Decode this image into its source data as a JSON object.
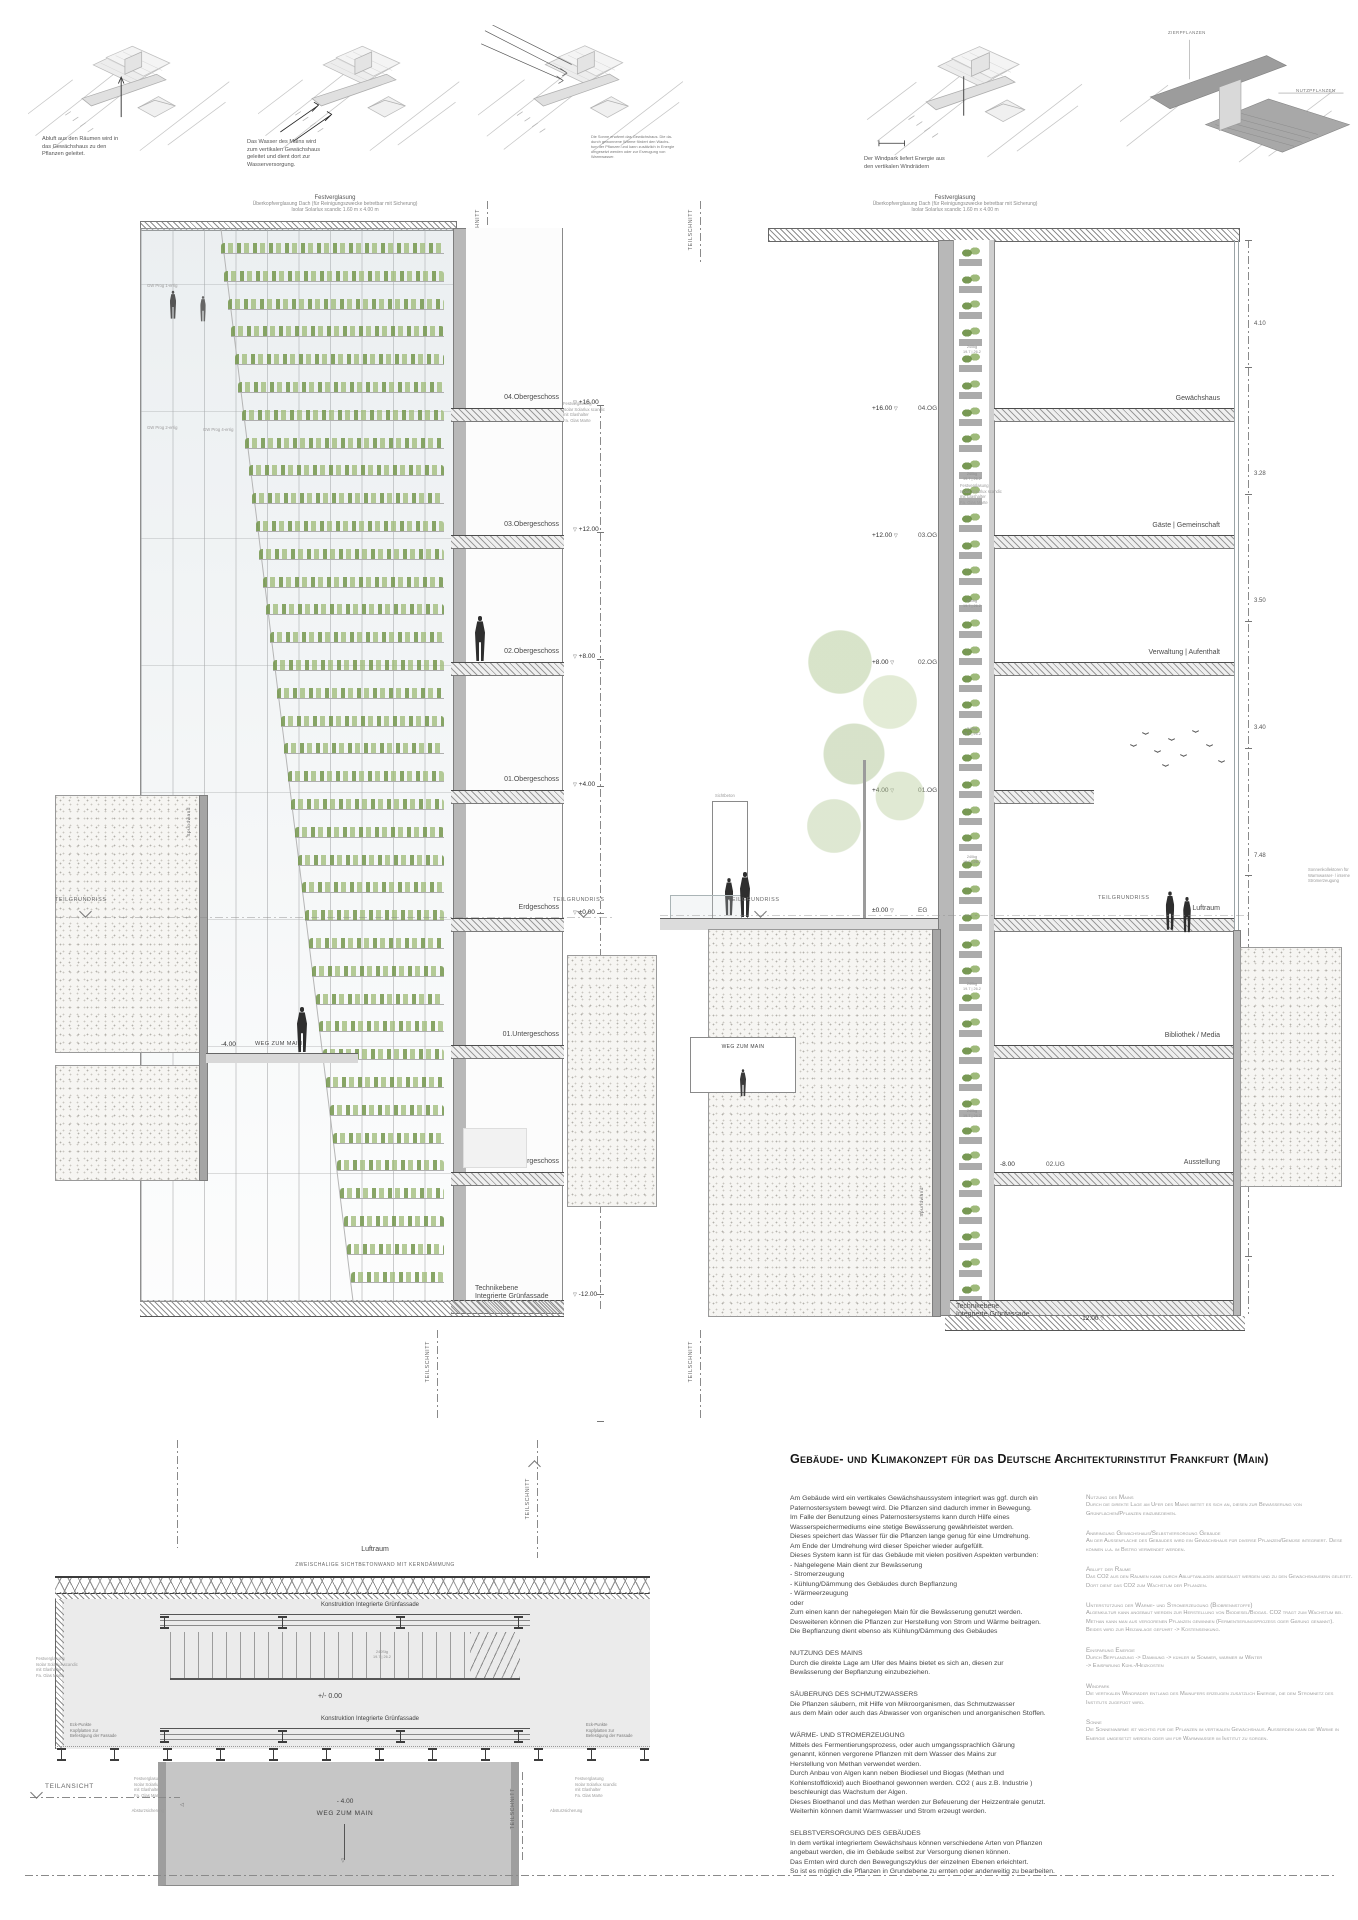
{
  "top_row": {
    "captions": [
      "Abluft aus den Räumen wird in\ndas Gewächshaus zu den\nPflanzen geleitet.",
      "Das Wasser des Mains wird\nzum vertikalen Gewächshaus\ngeleitet und dient dort zur\nWasserversorgung.",
      "Die Sonne erwärmt das Gewächshaus. Die da-\ndurch gewonnene Wärme fördert den Wachs-\ntum der Pflanzen und kann zusätzlich in Energie\numgesetzt werden oder zur Erzeugung von\nWarmwasser.",
      "Der Windpark liefert Energie aus\nden vertikalen Windrädern"
    ],
    "d5_labels": {
      "top": "ZIERPFLANZEN",
      "right": "NUTZPFLANZEN"
    }
  },
  "sections_common": {
    "roof_note_line1": "Festverglasung",
    "roof_note_line2": "Überkopfverglasung Dach (für Reinigungszwecke betretbar mit Sicherung)",
    "roof_note_line3": "Isolar Solarlux scandic 1.60 m x 4.00 m",
    "glazing_note": "Festverglasung\nIsolar Solarlux scandic\nmit Glashalter\nFa. Glas Marte",
    "teilschnitt": "TEILSCHNITT",
    "teilansicht": "TEILANSICHT",
    "teilgrundriss": "TEILGRUNDRISS",
    "spundwand": "Spundwand"
  },
  "left_section": {
    "floors": [
      {
        "elev": "+16.00",
        "label": "04.Obergeschoss"
      },
      {
        "elev": "+12.00",
        "label": "03.Obergeschoss"
      },
      {
        "elev": "+8.00",
        "label": "02.Obergeschoss"
      },
      {
        "elev": "+4.00",
        "label": "01.Obergeschoss"
      },
      {
        "elev": "±0.00",
        "label": "Erdgeschoss"
      },
      {
        "elev": "-4.00",
        "label": "01.Untergeschoss"
      },
      {
        "elev": "-8.00",
        "label": "02.Untergeschoss"
      },
      {
        "elev": "-12.00",
        "label": "Technikebene\nIntegrierte Grünfassade"
      }
    ],
    "walkway_elev": "-4.00",
    "walkway_label": "WEG ZUM MAIN",
    "fig_notes": [
      "GW Prog 1-errig",
      "GW Prog 2-errig",
      "GW Prog 4-errig"
    ]
  },
  "right_section": {
    "levels": [
      {
        "elev": "+16.00",
        "tag": "04.OG",
        "room": "Gewächshaus"
      },
      {
        "elev": "+12.00",
        "tag": "03.OG",
        "room": "Gäste | Gemeinschaft"
      },
      {
        "elev": "+8.00",
        "tag": "02.OG",
        "room": "Verwaltung | Aufenthalt"
      },
      {
        "elev": "+4.00",
        "tag": "01.OG",
        "room": ""
      },
      {
        "elev": "±0.00",
        "tag": "EG",
        "room": "Luftraum"
      },
      {
        "elev": "-4.00",
        "tag": "01.UG",
        "room": "Bibliothek / Media"
      },
      {
        "elev": "-8.00",
        "tag": "02.UG",
        "room": "Ausstellung"
      },
      {
        "elev": "-12.00",
        "tag": "",
        "room": "Technikebene\nIntegrierte Grünfassade"
      }
    ],
    "dims": [
      "4.10",
      "3.28",
      "3.50",
      "3.40",
      "7.48",
      "3.50",
      "3.50"
    ],
    "box_label": "240kg\n19.7 | 26.2",
    "sichtbeton": "Sichtbeton",
    "weg_label": "WEG ZUM MAIN",
    "sonnenkollektor_note": "Sonnenkollektoren für Warmwasser- / interne Stromerzeugung"
  },
  "detail": {
    "luftraum": "Luftraum",
    "wand_note": "ZWEISCHALIGE SICHTBETONWAND MIT KERNDÄMMUNG",
    "konstruktion": "Konstruktion Integrierte Grünfassade",
    "level": "+/- 0.00",
    "eckpunkte": "Eck-Punkte\nKopfplatten zur\nBefestigung der Fassade",
    "stair_dim": "240Stg\n19.7 | 26.2",
    "absturz": "Absturzsicherung",
    "minus4": "- 4.00",
    "weg": "WEG ZUM MAIN"
  },
  "text_block": {
    "title": "Gebäude- und Klimakonzept für das Deutsche Architekturinstitut Frankfurt (Main)",
    "left_col": [
      {
        "heading": "",
        "body": "Am Gebäude wird ein vertikales Gewächshaussystem integriert was ggf. durch ein Paternostersystem bewegt wird. Die Pflanzen sind dadurch immer in Bewegung.\nIm Falle der Benutzung eines Paternostersystems kann durch Hilfe eines Wasserspeichermediums eine stetige Bewässerung gewährleistet werden.\nDieses speichert das Wasser für die Pflanzen lange genug für eine Umdrehung.\nAm Ende der Umdrehung wird dieser Speicher wieder aufgefüllt.\nDieses System kann ist für das Gebäude mit vielen positiven Aspekten verbunden:\n- Nahgelegene Main dient zur Bewässerung\n- Stromerzeugung\n- Kühlung/Dämmung des Gebäudes durch Bepflanzung\n- Wärmeerzeugung\noder\nZum einen kann der nahegelegen Main für die Bewässerung genutzt werden.\nDesweiteren können die Pflanzen zur Herstellung von Strom und Wärme beitragen.\nDie Bepflanzung dient ebenso als Kühlung/Dämmung des Gebäudes"
      },
      {
        "heading": "NUTZUNG DES MAINS",
        "body": "Durch die direkte Lage am Ufer des Mains bietet es sich an, diesen zur\nBewässerung der Bepflanzung einzubeziehen."
      },
      {
        "heading": "SÄUBERUNG DES SCHMUTZWASSERS",
        "body": "Die Pflanzen säubern, mit Hilfe von Mikroorganismen, das Schmutzwasser\naus dem Main oder auch das Abwasser von organischen und anorganischen Stoffen."
      },
      {
        "heading": "WÄRME- UND STROMERZEUGUNG",
        "body": "Mittels des Fermentierungsprozess, oder auch umgangssprachlich Gärung\ngenannt, können vergorene Pflanzen mit dem Wasser des Mains zur\nHerstellung von Methan verwendet werden.\nDurch Anbau von Algen kann neben Biodiesel und Biogas (Methan und\nKohlenstoffdioxid) auch Bioethanol gewonnen werden. CO2 ( aus z.B. Industrie )\nbeschleunigt das Wachstum der Algen.\nDieses Bioethanol und das Methan werden zur Befeuerung der Heizzentrale genutzt.\nWeiterhin können damit Warmwasser und Strom erzeugt werden."
      },
      {
        "heading": "SELBSTVERSORGUNG DES GEBÄUDES",
        "body": "In dem vertikal integriertem Gewächshaus können verschiedene Arten von Pflanzen\nangebaut werden, die im Gebäude selbst zur Versorgung dienen können.\nDas Ernten wird durch den Bewegungszyklus der einzelnen Ebenen erleichtert.\nSo ist es möglich die Pflanzen in Grundebene zu ernten oder anderweitig zu bearbeiten."
      }
    ],
    "right_col": [
      {
        "heading": "Nutzung des Mains",
        "body": "Durch die direkte Lage am Ufer des Mains bietet es sich an, diesen zur Bewässerung von Grünflächen/Pflanzen einzubeziehen."
      },
      {
        "heading": "Anbringung Gewächshaus/Selbstversorgung Gebäude",
        "body": "An der Aussenfläche des Gebäudes wird ein Gewächshaus für diverse Pflanzen/Gemüse integriert. Diese können u.a. im Bistro verwendet werden."
      },
      {
        "heading": "Abluft der Räume",
        "body": "Das CO2 aus den Räumen kann durch Abluftanlagen abgesaugt werden und zu den Gewächshäusern geleitet. Dort dient das CO2 zum Wachstum der Pflanzen."
      },
      {
        "heading": "Unterstützung der Wärme- und Stromerzeugung (Biobrennstoffe)",
        "body": "Algenkultur kann angebaut werden zur Herstellung von Biodiesel/Biogas. CO2 trägt zum Wachstum bei.\nMethan kann man aus vergorenen Pflanzen gewinnen (Fermentierungsprozess oder Gärung genannt).\nBeides wird zur Heizanlage geführt -> Kostensenkung."
      },
      {
        "heading": "Einsparung Energie",
        "body": "Durch Bepflanzung -> Dämmung -> kühler im Sommer, wärmer im Winter\n-> Einsparung Kühl-/Heizkosten"
      },
      {
        "heading": "Windpark",
        "body": "Die vertikalen Windräder entlang des Mainufers erzeugen zusätzlich Energie, die dem Stromnetz des Instituts zugefügt wird."
      },
      {
        "heading": "Sonne",
        "body": "Die Sonnenwärme ist wichtig für die Pflanzen im vertikalen Gewächshaus. Ausserdem kann die Wärme in Energie umgesetzt werden oder um für Warmwasser im Institut zu sorgen."
      }
    ]
  }
}
